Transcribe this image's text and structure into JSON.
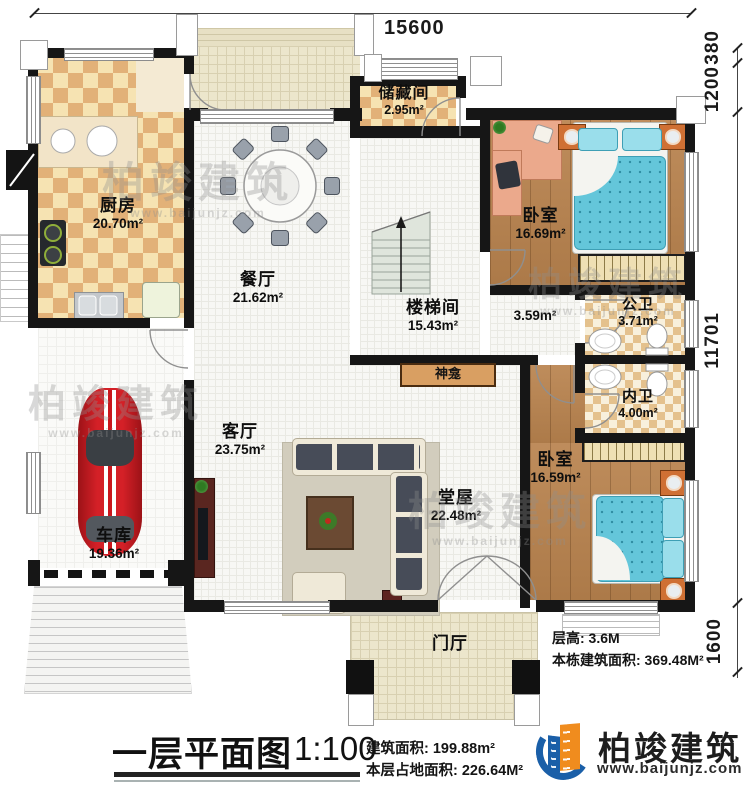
{
  "plan": {
    "dimensions": {
      "top_width": "15600",
      "right_segments": [
        "380",
        "1200",
        "11701",
        "1600"
      ]
    },
    "rooms": {
      "kitchen": {
        "name": "厨房",
        "area": "20.70m²"
      },
      "dining": {
        "name": "餐厅",
        "area": "21.62m²"
      },
      "storage": {
        "name": "储藏间",
        "area": "2.95m²"
      },
      "stairwell": {
        "name": "楼梯间",
        "area": "15.43m²"
      },
      "corridor": {
        "area": "3.59m²"
      },
      "bedroom_top": {
        "name": "卧室",
        "area": "16.69m²"
      },
      "bath_public": {
        "name": "公卫",
        "area": "3.71m²"
      },
      "bath_ensuite": {
        "name": "内卫",
        "area": "4.00m²"
      },
      "bedroom_bottom": {
        "name": "卧室",
        "area": "16.59m²"
      },
      "living": {
        "name": "客厅",
        "area": "23.75m²"
      },
      "hall": {
        "name": "堂屋",
        "area": "22.48m²"
      },
      "garage": {
        "name": "车库",
        "area": "19.36m²"
      },
      "foyer": {
        "name": "门厅"
      },
      "shrine": {
        "name": "神龛"
      }
    },
    "notes": {
      "floor_height": "层高: 3.6M",
      "building_total_area": "本栋建筑面积: 369.48M²"
    }
  },
  "title_block": {
    "title": "一层平面图",
    "scale": "1:100",
    "floor_area": "建筑面积: 199.88m²",
    "footprint_area": "本层占地面积: 226.64M²"
  },
  "brand": {
    "name": "柏竣建筑",
    "website": "www.baijunjz.com"
  }
}
